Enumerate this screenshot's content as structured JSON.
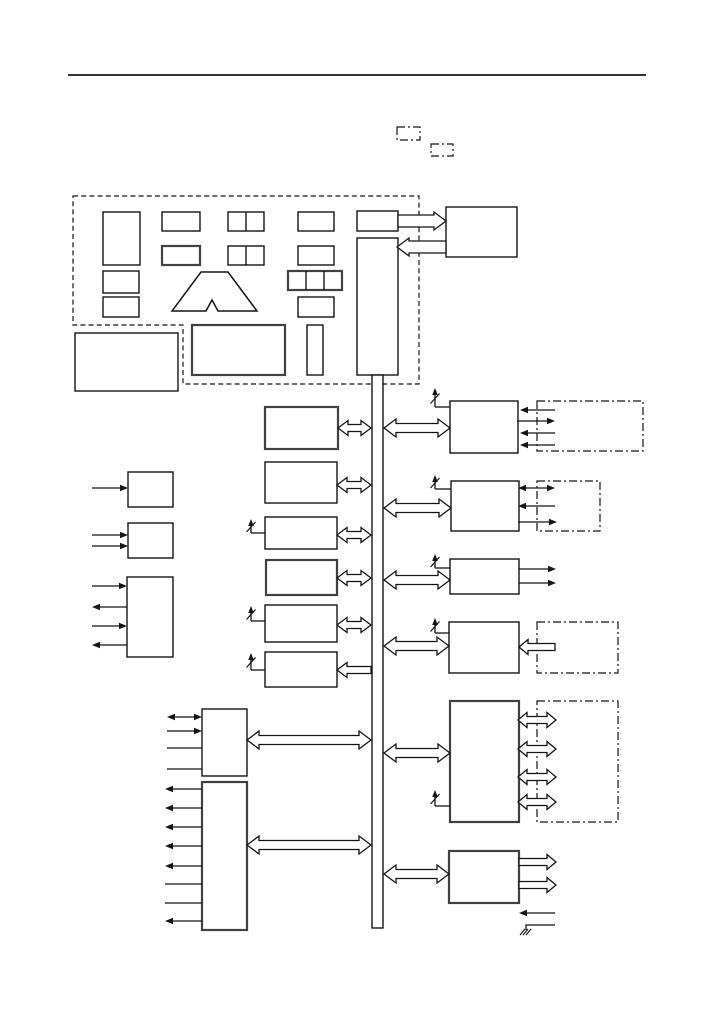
{
  "colors": {
    "background": "#ffffff",
    "ink": "#141414",
    "bold_ink": "#404040",
    "arrow_fill": "#ffffff"
  },
  "diagram": {
    "canvas": {
      "width": 717,
      "height": 1013
    },
    "header_rule": {
      "name": "header-rule",
      "x1": 68,
      "y1": 75,
      "x2": 646,
      "y2": 75,
      "width": 1.8
    },
    "dashed_outline": {
      "name": "controller-dashed-boundary",
      "path": "M73,196 H419 V384 H183 V325 H73 Z"
    },
    "dashdot_boxes": [
      {
        "name": "dashdot-box-top-1",
        "x": 397,
        "y": 127,
        "w": 23,
        "h": 13
      },
      {
        "name": "dashdot-box-top-2",
        "x": 431,
        "y": 144,
        "w": 22,
        "h": 12
      },
      {
        "name": "dashdot-box-right-1",
        "x": 537,
        "y": 401,
        "w": 106,
        "h": 50
      },
      {
        "name": "dashdot-box-right-2",
        "x": 537,
        "y": 481,
        "w": 63,
        "h": 50
      },
      {
        "name": "dashdot-box-right-4",
        "x": 537,
        "y": 622,
        "w": 81,
        "h": 51
      },
      {
        "name": "dashdot-box-right-5",
        "x": 537,
        "y": 701,
        "w": 81,
        "h": 121
      }
    ],
    "blocks": [
      {
        "name": "controller-tall-block",
        "x": 103,
        "y": 212,
        "w": 37,
        "h": 53,
        "bold": false
      },
      {
        "name": "controller-small-block-1",
        "x": 103,
        "y": 271,
        "w": 36,
        "h": 22,
        "bold": false
      },
      {
        "name": "controller-small-block-2",
        "x": 103,
        "y": 297,
        "w": 36,
        "h": 20,
        "bold": false
      },
      {
        "name": "controller-mid-block-1",
        "x": 162,
        "y": 212,
        "w": 38,
        "h": 19,
        "bold": false
      },
      {
        "name": "controller-mid-block-2",
        "x": 162,
        "y": 246,
        "w": 38,
        "h": 19,
        "bold": true
      },
      {
        "name": "controller-split2-block-1",
        "x": 228,
        "y": 212,
        "w": 36,
        "h": 19,
        "bold": false,
        "dividers": [
          246
        ]
      },
      {
        "name": "controller-split2-block-2",
        "x": 228,
        "y": 246,
        "w": 36,
        "h": 19,
        "bold": false,
        "dividers": [
          246
        ]
      },
      {
        "name": "controller-right-block-1",
        "x": 298,
        "y": 212,
        "w": 36,
        "h": 19,
        "bold": false
      },
      {
        "name": "controller-right-block-2",
        "x": 298,
        "y": 246,
        "w": 36,
        "h": 19,
        "bold": false
      },
      {
        "name": "controller-split3-block",
        "x": 288,
        "y": 271,
        "w": 54,
        "h": 19,
        "bold": true,
        "dividers": [
          306,
          324
        ]
      },
      {
        "name": "controller-right-block-3",
        "x": 298,
        "y": 297,
        "w": 36,
        "h": 20,
        "bold": false
      },
      {
        "name": "bus-feeder-block",
        "x": 357,
        "y": 211,
        "w": 41,
        "h": 20,
        "bold": false
      },
      {
        "name": "controller-lower-wide-block",
        "x": 192,
        "y": 325,
        "w": 93,
        "h": 50,
        "bold": true
      },
      {
        "name": "controller-lower-narrow-block",
        "x": 307,
        "y": 325,
        "w": 16,
        "h": 50,
        "bold": false
      },
      {
        "name": "standalone-lower-left-block",
        "x": 75,
        "y": 333,
        "w": 103,
        "h": 58,
        "bold": false
      },
      {
        "name": "external-top-right-block",
        "x": 446,
        "y": 207,
        "w": 71,
        "h": 50,
        "bold": false
      },
      {
        "name": "bus-head-block",
        "x": 357,
        "y": 238,
        "w": 41,
        "h": 137,
        "bold": false
      },
      {
        "name": "vertical-bus",
        "x": 372,
        "y": 375,
        "w": 11,
        "h": 553,
        "bold": false
      },
      {
        "name": "center-block-1",
        "x": 265,
        "y": 407,
        "w": 73,
        "h": 42,
        "bold": true
      },
      {
        "name": "center-block-2",
        "x": 265,
        "y": 462,
        "w": 72,
        "h": 41,
        "bold": false
      },
      {
        "name": "center-block-3",
        "x": 265,
        "y": 517,
        "w": 72,
        "h": 32,
        "bold": false
      },
      {
        "name": "center-block-4",
        "x": 266,
        "y": 560,
        "w": 71,
        "h": 35,
        "bold": true
      },
      {
        "name": "center-block-5",
        "x": 265,
        "y": 605,
        "w": 72,
        "h": 37,
        "bold": false
      },
      {
        "name": "center-block-6",
        "x": 265,
        "y": 652,
        "w": 72,
        "h": 35,
        "bold": false
      },
      {
        "name": "left-input-block-1",
        "x": 128,
        "y": 472,
        "w": 45,
        "h": 35,
        "bold": false
      },
      {
        "name": "left-input-block-2",
        "x": 128,
        "y": 523,
        "w": 45,
        "h": 35,
        "bold": false
      },
      {
        "name": "left-io-block",
        "x": 127,
        "y": 577,
        "w": 46,
        "h": 80,
        "bold": false
      },
      {
        "name": "port-block-upper",
        "x": 202,
        "y": 709,
        "w": 45,
        "h": 67,
        "bold": false
      },
      {
        "name": "port-block-lower",
        "x": 202,
        "y": 782,
        "w": 45,
        "h": 148,
        "bold": true
      },
      {
        "name": "right-block-1",
        "x": 450,
        "y": 401,
        "w": 68,
        "h": 52,
        "bold": false
      },
      {
        "name": "right-block-2",
        "x": 451,
        "y": 481,
        "w": 68,
        "h": 50,
        "bold": false
      },
      {
        "name": "right-block-3",
        "x": 450,
        "y": 559,
        "w": 69,
        "h": 35,
        "bold": false
      },
      {
        "name": "right-block-4",
        "x": 449,
        "y": 622,
        "w": 70,
        "h": 51,
        "bold": false
      },
      {
        "name": "right-block-5",
        "x": 450,
        "y": 701,
        "w": 69,
        "h": 121,
        "bold": true
      },
      {
        "name": "right-block-6",
        "x": 449,
        "y": 851,
        "w": 70,
        "h": 52,
        "bold": true
      }
    ],
    "trapezoid": {
      "name": "logo-trapezoid-shape",
      "points": "201,272 228,272 257,311 218,311 212,300 206,311 172,311"
    },
    "hollow_arrows": [
      {
        "name": "arrow-feeder-to-external",
        "x1": 398,
        "x2": 446,
        "y": 221,
        "dir": "right",
        "sw": 12,
        "hw": 18,
        "hl": 12
      },
      {
        "name": "arrow-external-to-bushead",
        "x1": 397,
        "x2": 446,
        "y": 247,
        "dir": "left",
        "sw": 12,
        "hw": 18,
        "hl": 12
      },
      {
        "name": "bus-arrow-center-1",
        "x1": 338,
        "x2": 371,
        "y": 428,
        "dir": "both",
        "sw": 7,
        "hw": 15,
        "hl": 10
      },
      {
        "name": "bus-arrow-center-2",
        "x1": 337,
        "x2": 371,
        "y": 485,
        "dir": "both",
        "sw": 7,
        "hw": 15,
        "hl": 10
      },
      {
        "name": "bus-arrow-center-3",
        "x1": 337,
        "x2": 371,
        "y": 535,
        "dir": "both",
        "sw": 7,
        "hw": 15,
        "hl": 10
      },
      {
        "name": "bus-arrow-center-4",
        "x1": 337,
        "x2": 371,
        "y": 578,
        "dir": "both",
        "sw": 7,
        "hw": 15,
        "hl": 10
      },
      {
        "name": "bus-arrow-center-5",
        "x1": 337,
        "x2": 371,
        "y": 625,
        "dir": "both",
        "sw": 7,
        "hw": 15,
        "hl": 10
      },
      {
        "name": "bus-arrow-center-6",
        "x1": 337,
        "x2": 371,
        "y": 670,
        "dir": "left",
        "sw": 7,
        "hw": 15,
        "hl": 10
      },
      {
        "name": "bus-arrow-right-1",
        "x1": 384,
        "x2": 450,
        "y": 428,
        "dir": "both",
        "sw": 9,
        "hw": 18,
        "hl": 12
      },
      {
        "name": "bus-arrow-right-2",
        "x1": 384,
        "x2": 451,
        "y": 508,
        "dir": "both",
        "sw": 9,
        "hw": 18,
        "hl": 12
      },
      {
        "name": "bus-arrow-right-3",
        "x1": 384,
        "x2": 450,
        "y": 580,
        "dir": "both",
        "sw": 9,
        "hw": 18,
        "hl": 12
      },
      {
        "name": "bus-arrow-right-4",
        "x1": 384,
        "x2": 449,
        "y": 646,
        "dir": "both",
        "sw": 9,
        "hw": 18,
        "hl": 12
      },
      {
        "name": "bus-arrow-right-5",
        "x1": 384,
        "x2": 450,
        "y": 753,
        "dir": "both",
        "sw": 9,
        "hw": 18,
        "hl": 12
      },
      {
        "name": "bus-arrow-right-6",
        "x1": 384,
        "x2": 449,
        "y": 874,
        "dir": "both",
        "sw": 9,
        "hw": 18,
        "hl": 12
      },
      {
        "name": "bus-arrow-port-upper",
        "x1": 247,
        "x2": 371,
        "y": 740,
        "dir": "both",
        "sw": 9,
        "hw": 18,
        "hl": 12
      },
      {
        "name": "bus-arrow-port-lower",
        "x1": 247,
        "x2": 371,
        "y": 845,
        "dir": "both",
        "sw": 9,
        "hw": 18,
        "hl": 12
      },
      {
        "name": "right4-input-arrow",
        "x1": 519,
        "x2": 555,
        "y": 647,
        "dir": "left",
        "sw": 7,
        "hw": 15,
        "hl": 9
      },
      {
        "name": "right5-io-arrow-1",
        "x1": 518,
        "x2": 556,
        "y": 720,
        "dir": "both",
        "sw": 7,
        "hw": 15,
        "hl": 9
      },
      {
        "name": "right5-io-arrow-2",
        "x1": 518,
        "x2": 556,
        "y": 749,
        "dir": "both",
        "sw": 7,
        "hw": 15,
        "hl": 9
      },
      {
        "name": "right5-io-arrow-3",
        "x1": 518,
        "x2": 556,
        "y": 777,
        "dir": "both",
        "sw": 7,
        "hw": 15,
        "hl": 9
      },
      {
        "name": "right5-io-arrow-4",
        "x1": 518,
        "x2": 556,
        "y": 802,
        "dir": "both",
        "sw": 7,
        "hw": 15,
        "hl": 9
      },
      {
        "name": "right6-out-arrow-1",
        "x1": 519,
        "x2": 556,
        "y": 862,
        "dir": "right",
        "sw": 7,
        "hw": 15,
        "hl": 9
      },
      {
        "name": "right6-out-arrow-2",
        "x1": 519,
        "x2": 556,
        "y": 885,
        "dir": "right",
        "sw": 7,
        "hw": 15,
        "hl": 9
      }
    ],
    "thin_arrows": [
      {
        "name": "input-arrow-a",
        "x1": 92,
        "x2": 128,
        "y": 488,
        "dir": "right"
      },
      {
        "name": "input-arrow-b1",
        "x1": 92,
        "x2": 128,
        "y": 535,
        "dir": "right"
      },
      {
        "name": "input-arrow-b2",
        "x1": 92,
        "x2": 128,
        "y": 546,
        "dir": "right"
      },
      {
        "name": "io-arrow-c1",
        "x1": 92,
        "x2": 127,
        "y": 586,
        "dir": "right"
      },
      {
        "name": "io-arrow-c2",
        "x1": 92,
        "x2": 127,
        "y": 607,
        "dir": "left"
      },
      {
        "name": "io-arrow-c3",
        "x1": 92,
        "x2": 127,
        "y": 626,
        "dir": "right"
      },
      {
        "name": "io-arrow-c4",
        "x1": 92,
        "x2": 127,
        "y": 645,
        "dir": "left"
      },
      {
        "name": "port-upper-link-1",
        "x1": 167,
        "x2": 202,
        "y": 717,
        "dir": "both"
      },
      {
        "name": "port-upper-link-2",
        "x1": 167,
        "x2": 202,
        "y": 731,
        "dir": "right"
      },
      {
        "name": "port-upper-link-3",
        "x1": 167,
        "x2": 202,
        "y": 748,
        "dir": "none"
      },
      {
        "name": "port-upper-link-4",
        "x1": 167,
        "x2": 202,
        "y": 769,
        "dir": "none"
      },
      {
        "name": "port-lower-link-1",
        "x1": 165,
        "x2": 202,
        "y": 789,
        "dir": "left"
      },
      {
        "name": "port-lower-link-2",
        "x1": 165,
        "x2": 202,
        "y": 808,
        "dir": "left"
      },
      {
        "name": "port-lower-link-3",
        "x1": 165,
        "x2": 202,
        "y": 827,
        "dir": "left"
      },
      {
        "name": "port-lower-link-4",
        "x1": 165,
        "x2": 202,
        "y": 846,
        "dir": "left"
      },
      {
        "name": "port-lower-link-5",
        "x1": 165,
        "x2": 202,
        "y": 866,
        "dir": "left"
      },
      {
        "name": "port-lower-link-6",
        "x1": 165,
        "x2": 202,
        "y": 884,
        "dir": "none"
      },
      {
        "name": "port-lower-link-7",
        "x1": 165,
        "x2": 202,
        "y": 903,
        "dir": "none"
      },
      {
        "name": "port-lower-link-8",
        "x1": 165,
        "x2": 202,
        "y": 921,
        "dir": "left"
      },
      {
        "name": "right1-io-1",
        "x1": 520,
        "x2": 555,
        "y": 410,
        "dir": "left"
      },
      {
        "name": "right1-io-2",
        "x1": 517,
        "x2": 555,
        "y": 421,
        "dir": "right"
      },
      {
        "name": "right1-io-3",
        "x1": 520,
        "x2": 555,
        "y": 433,
        "dir": "left"
      },
      {
        "name": "right1-io-4",
        "x1": 520,
        "x2": 555,
        "y": 445,
        "dir": "left"
      },
      {
        "name": "right2-io-1",
        "x1": 518,
        "x2": 555,
        "y": 488,
        "dir": "both"
      },
      {
        "name": "right2-io-2",
        "x1": 518,
        "x2": 555,
        "y": 506,
        "dir": "left"
      },
      {
        "name": "right2-io-3",
        "x1": 518,
        "x2": 557,
        "y": 522,
        "dir": "right"
      },
      {
        "name": "right3-out-1",
        "x1": 519,
        "x2": 556,
        "y": 569,
        "dir": "right"
      },
      {
        "name": "right3-out-2",
        "x1": 519,
        "x2": 556,
        "y": 583,
        "dir": "right"
      },
      {
        "name": "right6-in-arrow",
        "x1": 519,
        "x2": 555,
        "y": 913,
        "dir": "left"
      }
    ],
    "interrupts": [
      {
        "name": "interrupt-center-3",
        "vx": 251,
        "tip": 519,
        "elbow": 533,
        "toX": 265
      },
      {
        "name": "interrupt-center-5",
        "vx": 251,
        "tip": 606,
        "elbow": 621,
        "toX": 265
      },
      {
        "name": "interrupt-center-6",
        "vx": 251,
        "tip": 653,
        "elbow": 670,
        "toX": 265
      },
      {
        "name": "interrupt-right-1",
        "vx": 435,
        "tip": 388,
        "elbow": 407,
        "toX": 450
      },
      {
        "name": "interrupt-right-2",
        "vx": 435,
        "tip": 475,
        "elbow": 489,
        "toX": 451
      },
      {
        "name": "interrupt-right-3",
        "vx": 435,
        "tip": 554,
        "elbow": 568,
        "toX": 450
      },
      {
        "name": "interrupt-right-4",
        "vx": 435,
        "tip": 618,
        "elbow": 633,
        "toX": 449
      },
      {
        "name": "interrupt-right-5",
        "vx": 435,
        "tip": 790,
        "elbow": 806,
        "toX": 450
      }
    ],
    "ground": {
      "name": "ground-symbol",
      "feed": "555,925 526,925 526,930",
      "hatch": [
        {
          "x1": 520,
          "y1": 935,
          "x2": 525,
          "y2": 929
        },
        {
          "x1": 523,
          "y1": 935,
          "x2": 528,
          "y2": 929
        },
        {
          "x1": 526,
          "y1": 935,
          "x2": 531,
          "y2": 929
        }
      ]
    }
  }
}
